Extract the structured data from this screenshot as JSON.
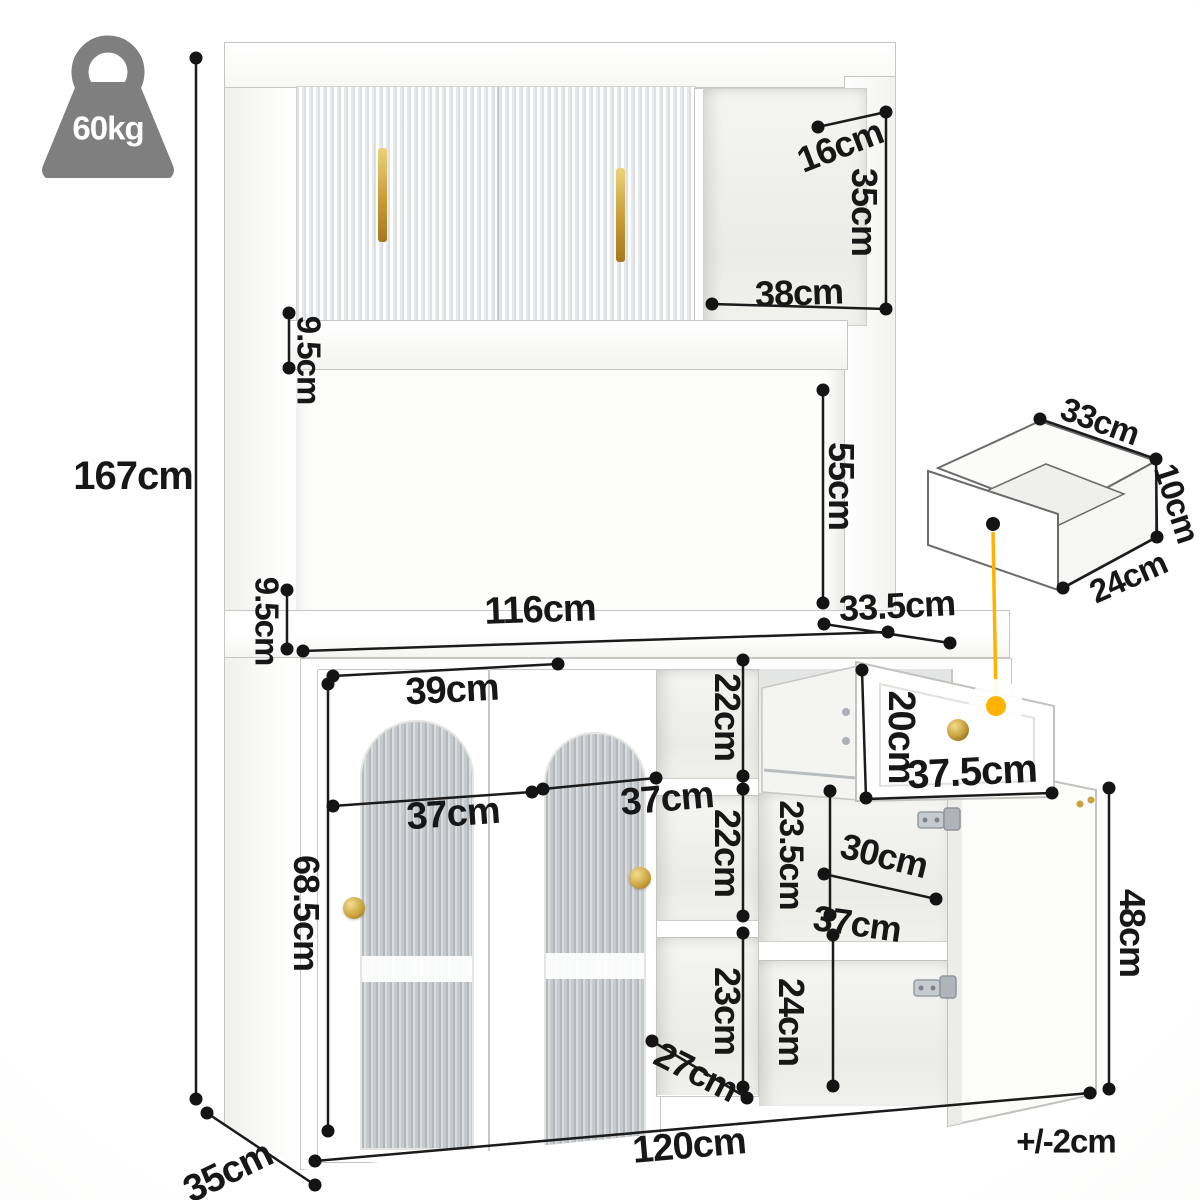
{
  "meta": {
    "type": "furniture-dimension-diagram",
    "subject": "white kitchen hutch storage cabinet with fluted glass doors, open drawer and open door"
  },
  "weight": {
    "label": "60kg",
    "icon": "weight-capacity-icon",
    "color": "#7f7f7f"
  },
  "tolerance": {
    "label": "+/-2cm"
  },
  "overall": {
    "height": {
      "label": "167cm"
    },
    "width": {
      "label": "120cm"
    },
    "depth": {
      "label": "35cm"
    }
  },
  "hutch": {
    "top_cubby": {
      "depth": {
        "label": "16cm"
      },
      "height": {
        "label": "35cm"
      },
      "width": {
        "label": "38cm"
      }
    },
    "shelf_rail_thickness": {
      "label": "9.5cm"
    },
    "open_space_height": {
      "label": "55cm"
    },
    "countertop_thickness": {
      "label": "9.5cm"
    },
    "countertop_width": {
      "label": "116cm"
    },
    "countertop_depth": {
      "label": "33.5cm"
    }
  },
  "drawer_detail": {
    "width": {
      "label": "33cm"
    },
    "height": {
      "label": "10cm"
    },
    "depth": {
      "label": "24cm"
    }
  },
  "base": {
    "left_door_top_width": {
      "label": "39cm"
    },
    "left_door_width": {
      "label": "37cm"
    },
    "left_door_height": {
      "label": "68.5cm"
    },
    "center_door_width": {
      "label": "37cm"
    },
    "middle_cubby_top_height": {
      "label": "22cm"
    },
    "middle_cubby_mid_height": {
      "label": "22cm"
    },
    "middle_cubby_bottom_height": {
      "label": "23cm"
    },
    "middle_cubby_width": {
      "label": "27cm"
    },
    "drawer_front_height": {
      "label": "20cm"
    },
    "drawer_front_width": {
      "label": "37.5cm"
    },
    "right_upper_cubby_height": {
      "label": "23.5cm"
    },
    "right_shelf_depth": {
      "label": "30cm"
    },
    "right_shelf_width": {
      "label": "37cm"
    },
    "right_lower_cubby_height": {
      "label": "24cm"
    },
    "right_door_height": {
      "label": "48cm"
    }
  },
  "colors": {
    "dimension_line": "#1a1a1a",
    "handle_gold": "#c9a23a",
    "callout_yellow": "#ffb300",
    "icon_gray": "#7f7f7f",
    "cabinet_white": "#ffffff",
    "outline_gray": "#c6c6c2"
  }
}
